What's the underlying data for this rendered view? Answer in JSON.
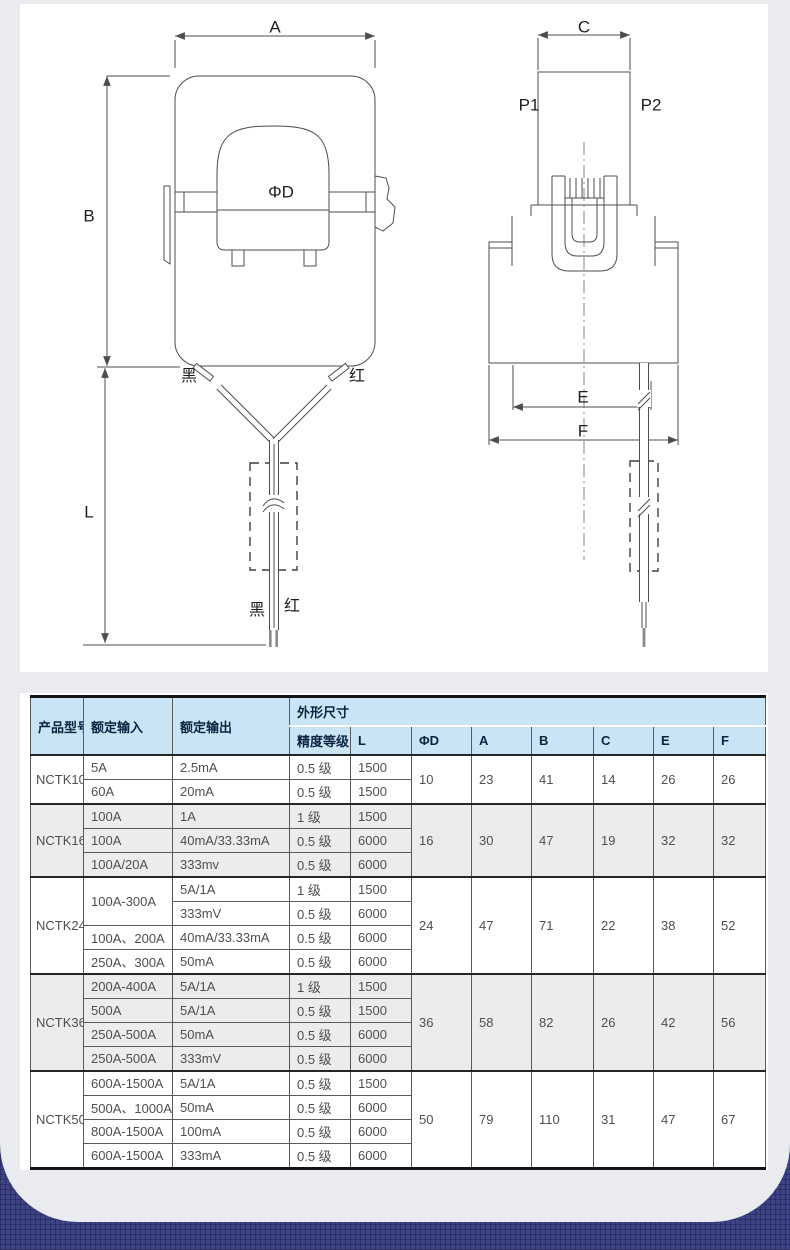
{
  "page": {
    "bg_navy": "#3d4486",
    "card_bg": "#e9ebef",
    "panel_bg": "#ffffff",
    "header_bg": "#c9e4f5",
    "shaded_row_bg": "#ececec"
  },
  "diagram": {
    "front_view": {
      "dim_a": "A",
      "dim_b": "B",
      "dim_phid": "ΦD",
      "dim_l": "L",
      "wire_black_top": "黑",
      "wire_red_top": "红",
      "wire_black_bottom": "黑",
      "wire_red_bottom": "红"
    },
    "side_view": {
      "dim_c": "C",
      "label_p1": "P1",
      "label_p2": "P2",
      "dim_e": "E",
      "dim_f": "F"
    }
  },
  "spec_table": {
    "headers": {
      "model": "产品型号",
      "rated_input": "额定输入",
      "rated_output": "额定输出",
      "dimensions_group": "外形尺寸",
      "accuracy": "精度等级",
      "length": "L",
      "sub": [
        "ΦD",
        "A",
        "B",
        "C",
        "E",
        "F"
      ]
    },
    "groups": [
      {
        "model": "NCTK10",
        "shaded": false,
        "rows": [
          {
            "input": "5A",
            "output": "2.5mA",
            "accuracy": "0.5 级",
            "L": "1500"
          },
          {
            "input": "60A",
            "output": "20mA",
            "accuracy": "0.5 级",
            "L": "1500"
          }
        ],
        "dims": {
          "phiD": "10",
          "A": "23",
          "B": "41",
          "C": "14",
          "E": "26",
          "F": "26"
        }
      },
      {
        "model": "NCTK16",
        "shaded": true,
        "rows": [
          {
            "input": "100A",
            "output": "1A",
            "accuracy": "1 级",
            "L": "1500"
          },
          {
            "input": "100A",
            "output": "40mA/33.33mA",
            "accuracy": "0.5 级",
            "L": "6000"
          },
          {
            "input": "100A/20A",
            "output": "333mv",
            "accuracy": "0.5 级",
            "L": "6000"
          }
        ],
        "dims": {
          "phiD": "16",
          "A": "30",
          "B": "47",
          "C": "19",
          "E": "32",
          "F": "32"
        }
      },
      {
        "model": "NCTK24",
        "shaded": false,
        "rows": [
          {
            "input": "100A-300A",
            "output": "5A/1A",
            "accuracy": "1 级",
            "L": "1500"
          },
          {
            "input": null,
            "output": "333mV",
            "accuracy": "0.5 级",
            "L": "6000"
          },
          {
            "input": "100A、200A",
            "output": "40mA/33.33mA",
            "accuracy": "0.5 级",
            "L": "6000"
          },
          {
            "input": "250A、300A",
            "output": "50mA",
            "accuracy": "0.5 级",
            "L": "6000"
          }
        ],
        "dims": {
          "phiD": "24",
          "A": "47",
          "B": "71",
          "C": "22",
          "E": "38",
          "F": "52"
        }
      },
      {
        "model": "NCTK36",
        "shaded": true,
        "rows": [
          {
            "input": "200A-400A",
            "output": "5A/1A",
            "accuracy": "1 级",
            "L": "1500"
          },
          {
            "input": "500A",
            "output": "5A/1A",
            "accuracy": "0.5 级",
            "L": "1500"
          },
          {
            "input": "250A-500A",
            "output": "50mA",
            "accuracy": "0.5 级",
            "L": "6000"
          },
          {
            "input": "250A-500A",
            "output": "333mV",
            "accuracy": "0.5 级",
            "L": "6000"
          }
        ],
        "dims": {
          "phiD": "36",
          "A": "58",
          "B": "82",
          "C": "26",
          "E": "42",
          "F": "56"
        }
      },
      {
        "model": "NCTK50",
        "shaded": false,
        "rows": [
          {
            "input": "600A-1500A",
            "output": "5A/1A",
            "accuracy": "0.5 级",
            "L": "1500"
          },
          {
            "input": "500A、1000A",
            "output": "50mA",
            "accuracy": "0.5 级",
            "L": "6000"
          },
          {
            "input": "800A-1500A",
            "output": "100mA",
            "accuracy": "0.5 级",
            "L": "6000"
          },
          {
            "input": "600A-1500A",
            "output": "333mA",
            "accuracy": "0.5 级",
            "L": "6000"
          }
        ],
        "dims": {
          "phiD": "50",
          "A": "79",
          "B": "110",
          "C": "31",
          "E": "47",
          "F": "67"
        }
      }
    ]
  }
}
